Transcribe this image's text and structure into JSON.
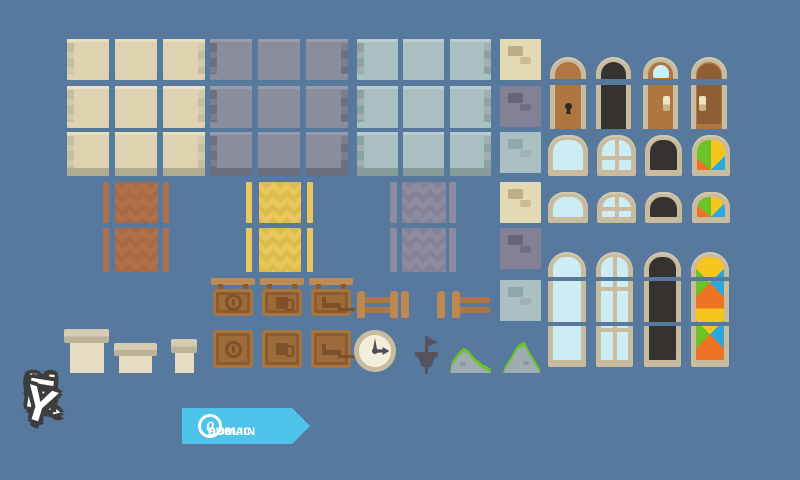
{
  "canvas": {
    "width": 800,
    "height": 480,
    "background_color": "#57799d"
  },
  "branding": {
    "logo_text": "KENNEY",
    "logo_letters": [
      "K",
      "E",
      "N",
      "N",
      "E",
      "Y"
    ],
    "badge": {
      "symbol": "0",
      "line1": "PUBLIC",
      "line2": "DOMAIN",
      "ribbon_color": "#4dc3ea"
    }
  },
  "palette": {
    "cream_wall": "#ddd3b1",
    "slate_wall": "#8b8d9d",
    "pale_wall": "#aabfc1",
    "frame_tan": "#c8bb9e",
    "door_brown": "#b0763f",
    "dark_glass": "#35322f",
    "glass_blue": "#cdedf4",
    "stained": [
      "#ee7425",
      "#6cc327",
      "#f6c51e",
      "#2ba7e0"
    ],
    "awning_green": "#6cc327",
    "awning_orange": "#ea7326",
    "awning_white": "#ffffff",
    "sign_wood": "#a8743f",
    "fence_wood": "#bd8851",
    "moss_green": "#6cc327",
    "rock_gray": "#9fadb2"
  },
  "assets": {
    "wall_rows": [
      {
        "y": 39,
        "h": 41
      },
      {
        "y": 86,
        "h": 42
      },
      {
        "y": 132,
        "h": 44
      }
    ],
    "wall_sets": [
      {
        "name": "cream",
        "cols": [
          67,
          115,
          163
        ],
        "width": 42
      },
      {
        "name": "slate",
        "cols": [
          210,
          258,
          306
        ],
        "width": 42
      },
      {
        "name": "pale",
        "cols": [
          357,
          403,
          450
        ],
        "width": 41
      }
    ],
    "stone_x": 500,
    "stone_blocks": [
      {
        "variant": "beige",
        "y": 39
      },
      {
        "variant": "gray",
        "y": 86
      },
      {
        "variant": "pale",
        "y": 132
      },
      {
        "variant": "beige",
        "y": 182
      },
      {
        "variant": "gray",
        "y": 228
      },
      {
        "variant": "pale",
        "y": 280
      }
    ],
    "curtains": {
      "rows": [
        {
          "y": 182,
          "h": 41
        },
        {
          "y": 228,
          "h": 44
        }
      ],
      "sets": [
        {
          "name": "brown",
          "strips": [
            103,
            163
          ],
          "strip_w": 6,
          "panel_x": 115,
          "panel_w": 43
        },
        {
          "name": "yellow",
          "strips": [
            246,
            307
          ],
          "strip_w": 6,
          "panel_x": 259,
          "panel_w": 42
        },
        {
          "name": "gray",
          "strips": [
            390,
            449
          ],
          "strip_w": 7,
          "panel_x": 402,
          "panel_w": 44
        }
      ]
    },
    "doors": [
      "door-wood-keyhole",
      "door-dark",
      "door-wood-window",
      "door-wood-panel"
    ],
    "round_windows": [
      "window-plain",
      "window-mullion",
      "window-dark",
      "window-stained"
    ],
    "tall_windows": [
      "tall-window-plain",
      "tall-window-mullion",
      "tall-window-dark",
      "tall-window-stained"
    ],
    "awnings": [
      {
        "name": "awning-green-white",
        "stripes": [
          "green",
          "white",
          "green",
          "white"
        ]
      },
      {
        "name": "awning-green-orange",
        "stripes": [
          "green",
          "orange",
          "green",
          "orange"
        ]
      },
      {
        "name": "awning-orange-white",
        "stripes": [
          "orange",
          "white",
          "orange",
          "white"
        ]
      }
    ],
    "signs": [
      {
        "icon": "coin"
      },
      {
        "icon": "mug"
      },
      {
        "icon": "bed"
      }
    ],
    "chimneys": [
      "chimney-large",
      "chimney-medium",
      "chimney-small"
    ],
    "props": [
      "fence",
      "fence-post",
      "clock",
      "weather-vane",
      "rock-wide",
      "rock-tall"
    ]
  }
}
